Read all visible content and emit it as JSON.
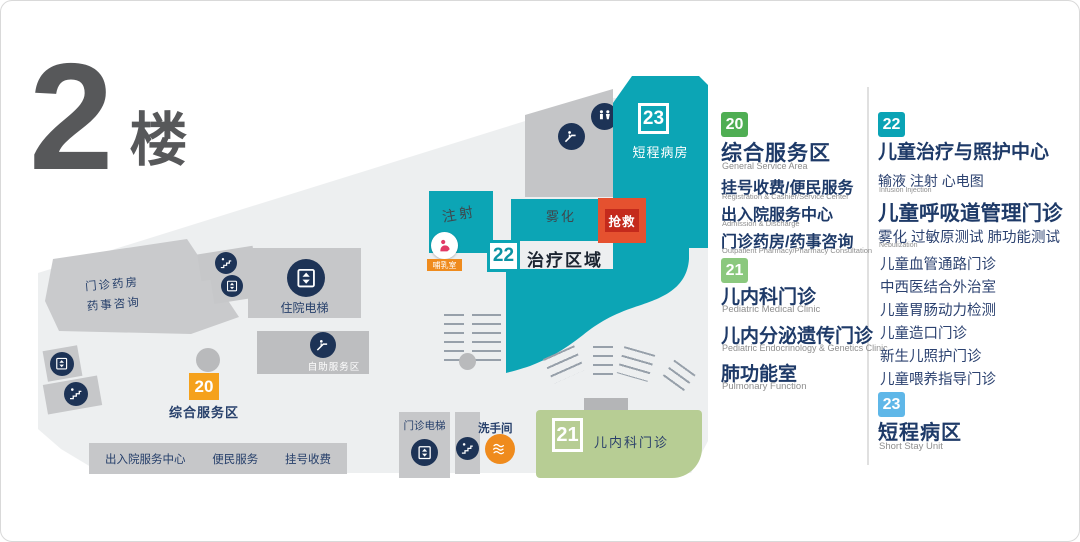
{
  "title": {
    "number": "2",
    "suffix": "楼"
  },
  "map": {
    "ward23": {
      "num": "23",
      "label": "短程病房"
    },
    "nebulization": "雾化",
    "rescue": "抢救",
    "injection": "注射",
    "nursing": "哺乳室",
    "area22": {
      "num": "22",
      "label": "治疗区域"
    },
    "clinic21": {
      "num": "21",
      "label": "儿内科门诊"
    },
    "labels": {
      "outpatient_elevator": "门诊电梯",
      "restroom": "洗手间",
      "inpatient_elevator": "住院电梯",
      "self_service": "自助服务区",
      "pharmacy_line1": "门诊药房",
      "pharmacy_line2": "药事咨询",
      "badge20": "20",
      "service_area": "综合服务区"
    },
    "bottom_bar": [
      "出入院服务中心",
      "便民服务",
      "挂号收费"
    ]
  },
  "legend": {
    "sections": [
      {
        "badge": "20",
        "badge_color": "#4fae53",
        "title": "综合服务区",
        "title_en": "General Service Area",
        "items": [
          {
            "zh": "挂号收费/便民服务",
            "en": "Registration & Cashier/Service Center"
          },
          {
            "zh": "出入院服务中心",
            "en": "Admission & Discharge"
          },
          {
            "zh": "门诊药房/药事咨询",
            "en": "Outpatient Pharmacy/Pharmacy Consultation"
          }
        ]
      },
      {
        "badge": "21",
        "badge_color": "#8bc87e",
        "items": [
          {
            "zh": "儿内科门诊",
            "en": "Pediatric Medical Clinic"
          },
          {
            "zh": "儿内分泌遗传门诊",
            "en": "Pediatric Endocrinology & Genetics Clinic"
          },
          {
            "zh": "肺功能室",
            "en": "Pulmonary Function"
          }
        ]
      },
      {
        "badge": "22",
        "badge_color": "#0aa3b5",
        "title": "儿童治疗与照护中心",
        "sub_zh": "输液 注射 心电图",
        "sub_en": "Infusion Injection",
        "title2": "儿童呼吸道管理门诊",
        "sub2_zh": "雾化 过敏原测试 肺功能测试",
        "sub2_en": "Nebulization",
        "list": [
          "儿童血管通路门诊",
          "中西医结合外治室",
          "儿童胃肠动力检测",
          "儿童造口门诊",
          "新生儿照护门诊",
          "儿童喂养指导门诊"
        ]
      },
      {
        "badge": "23",
        "badge_color": "#5fb7e8",
        "title": "短程病区",
        "title_en": "Short Stay Unit"
      }
    ]
  },
  "colors": {
    "teal": "#0ca5b5",
    "navy_text": "#27406b",
    "icon_circle": "#1d3356",
    "orange_badge": "#f5a11c",
    "rescue_red": "#e5512f",
    "clinic_green": "#b7cd94",
    "plate_gray": "#edeff0",
    "block_gray": "#c6c7c9"
  },
  "icons": {
    "elevator": "elevator-icon",
    "stairs": "stairs-icon",
    "escalator": "escalator-icon",
    "toilet": "toilet-icon",
    "nursing_room": "nursing-room-icon",
    "restroom": "restroom-icon"
  }
}
